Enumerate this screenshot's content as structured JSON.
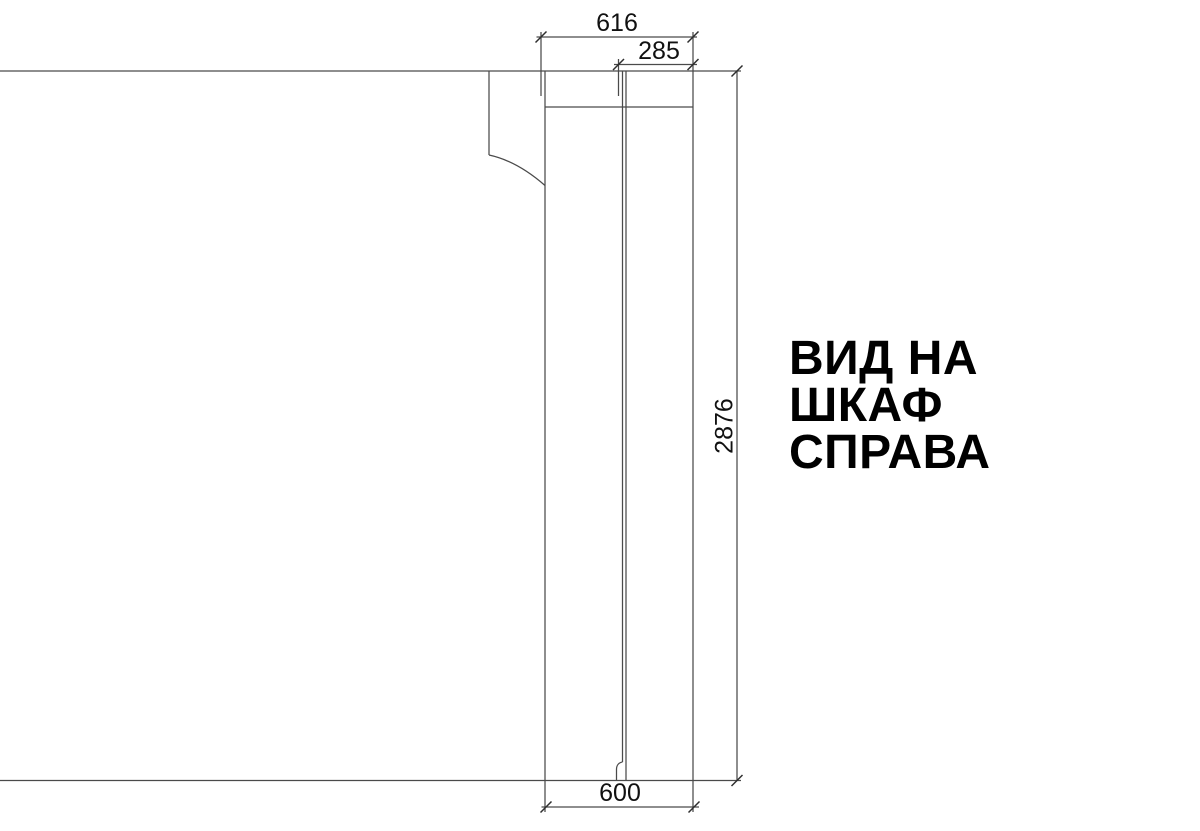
{
  "title": {
    "line1": "ВИД НА",
    "line2": "ШКАФ",
    "line3": "СПРАВА"
  },
  "dimensions": {
    "top_width": "616",
    "front_depth": "285",
    "height": "2876",
    "bottom_depth": "600"
  },
  "drawing": {
    "stroke_color": "#4a4a4a",
    "tick_color": "#2e2e2e",
    "line_width": 1.25,
    "tick_width": 1.5,
    "tick_half_length": 5.5,
    "segments": [
      {
        "name": "wall-top-line",
        "x1": 0,
        "y1": 71,
        "x2": 741,
        "y2": 71
      },
      {
        "name": "floor-bottom-line",
        "x1": 0,
        "y1": 780.5,
        "x2": 741,
        "y2": 780.5
      },
      {
        "name": "left-profile-vertical",
        "x1": 489,
        "y1": 71,
        "x2": 489,
        "y2": 155
      },
      {
        "name": "panel-left-edge",
        "x1": 545,
        "y1": 71,
        "x2": 545,
        "y2": 812
      },
      {
        "name": "panel-right-edge",
        "x1": 693,
        "y1": 32,
        "x2": 693,
        "y2": 812
      },
      {
        "name": "top-rail-bottom-line",
        "x1": 545,
        "y1": 107,
        "x2": 693,
        "y2": 107
      },
      {
        "name": "inner-panel-line-left",
        "x1": 622.5,
        "y1": 71,
        "x2": 622.5,
        "y2": 762
      },
      {
        "name": "inner-panel-line-right",
        "x1": 626,
        "y1": 71,
        "x2": 626,
        "y2": 780.5
      },
      {
        "name": "extension-616-left",
        "x1": 541,
        "y1": 32,
        "x2": 541,
        "y2": 96
      },
      {
        "name": "extension-285-left",
        "x1": 618.5,
        "y1": 59,
        "x2": 618.5,
        "y2": 96
      },
      {
        "name": "dim-line-616",
        "x1": 536.5,
        "y1": 37,
        "x2": 697,
        "y2": 37
      },
      {
        "name": "dim-line-285",
        "x1": 614,
        "y1": 64.5,
        "x2": 697,
        "y2": 64.5
      },
      {
        "name": "dim-line-600",
        "x1": 541.5,
        "y1": 807,
        "x2": 699,
        "y2": 807
      },
      {
        "name": "dim-line-2876",
        "x1": 737,
        "y1": 71,
        "x2": 737,
        "y2": 780.5
      }
    ],
    "paths": [
      {
        "name": "side-profile-curve",
        "d": "M 489,155 Q 517,161 545,185.5"
      },
      {
        "name": "inner-line-foot",
        "d": "M 622.5,762 C 619,762.5 616.5,765 616.5,769.5 L 616.5,780.5"
      }
    ],
    "ticks": [
      {
        "name": "tick-616-left",
        "x": 541,
        "y": 37
      },
      {
        "name": "tick-616-right",
        "x": 693,
        "y": 37
      },
      {
        "name": "tick-285-left",
        "x": 618.5,
        "y": 64.5
      },
      {
        "name": "tick-285-right",
        "x": 693,
        "y": 64.5
      },
      {
        "name": "tick-600-left",
        "x": 546,
        "y": 807
      },
      {
        "name": "tick-600-right",
        "x": 694,
        "y": 807
      },
      {
        "name": "tick-2876-top",
        "x": 737,
        "y": 71
      },
      {
        "name": "tick-2876-bottom",
        "x": 737,
        "y": 780.5
      }
    ]
  }
}
